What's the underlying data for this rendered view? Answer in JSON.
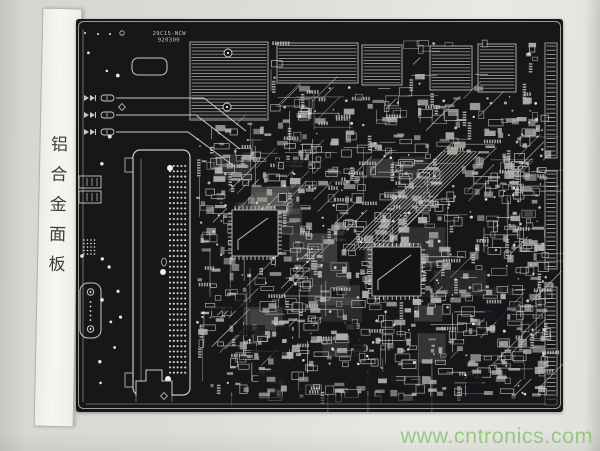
{
  "colors": {
    "paper": "#dddcd8",
    "board": "#17171a",
    "trace": "#c9c9c3",
    "fill_light": "#b5b5af",
    "dot": "#e4e4de",
    "label_text": "#3c3c38",
    "watermark": "#8fc77c"
  },
  "side_label": {
    "text": "铝合金面板",
    "characters": [
      "铝",
      "合",
      "金",
      "面",
      "板"
    ]
  },
  "silkscreen": {
    "line1": "29C15-NCW",
    "line2": "920300"
  },
  "watermark": {
    "text": "www.cntronics.com"
  },
  "pcb": {
    "seed": 1337,
    "hatch_blocks": [
      [
        114,
        23,
        78,
        78
      ],
      [
        201,
        24,
        81,
        40
      ],
      [
        286,
        26,
        40,
        40
      ],
      [
        354,
        27,
        42,
        44
      ],
      [
        402,
        25,
        38,
        48
      ]
    ],
    "hatch_pads": [
      [
        152,
        34
      ],
      [
        151,
        88
      ]
    ],
    "regions": [
      {
        "x": 120,
        "y": 128,
        "w": 348,
        "h": 248,
        "rects": 540,
        "lines": 160,
        "dots": 150,
        "skipHatch": false
      },
      {
        "x": 120,
        "y": 76,
        "w": 348,
        "h": 52,
        "rects": 120,
        "lines": 35,
        "dots": 35,
        "skipHatch": true
      },
      {
        "x": 195,
        "y": 20,
        "w": 268,
        "h": 56,
        "rects": 85,
        "lines": 25,
        "dots": 25,
        "skipHatch": true
      },
      {
        "x": 428,
        "y": 96,
        "w": 42,
        "h": 280,
        "rects": 55,
        "lines": 18,
        "dots": 25,
        "skipHatch": false
      }
    ],
    "texture_base": 26,
    "dark_patches": 16,
    "pass2_rects": 140,
    "left_dots": 14,
    "qfps": [
      [
        156,
        191,
        46
      ],
      [
        296,
        228,
        49
      ]
    ],
    "connector": {
      "x": 57,
      "y": 131,
      "w": 57,
      "h": 245
    },
    "ladders": [
      [
        469,
        24,
        115
      ],
      [
        469,
        152,
        98
      ],
      [
        469,
        268,
        118
      ]
    ],
    "led_rows": [
      [
        79,
        128,
        170,
        112
      ],
      [
        96,
        120,
        164,
        130
      ],
      [
        113,
        112,
        158,
        147
      ]
    ],
    "bundle": {
      "n": 11,
      "x1": 268,
      "y1": 231,
      "x2": 366,
      "y2": 133,
      "step": 3.8
    },
    "db_connector": {
      "x": 4,
      "y": 264,
      "w": 21,
      "h": 55
    },
    "comp_pair": [
      [
        3,
        157,
        22,
        12
      ],
      [
        3,
        172,
        22,
        12
      ]
    ],
    "dotted_block": [
      6,
      219,
      16,
      18
    ],
    "osc": [
      56,
      39,
      35,
      17
    ],
    "cutout_path": "M60 383 V362 H70 V351 H86 V362 H96 V383",
    "top_dots": [
      [
        9,
        14
      ],
      [
        22,
        15
      ],
      [
        34,
        15
      ]
    ],
    "top_circle": [
      46,
      14
    ]
  }
}
